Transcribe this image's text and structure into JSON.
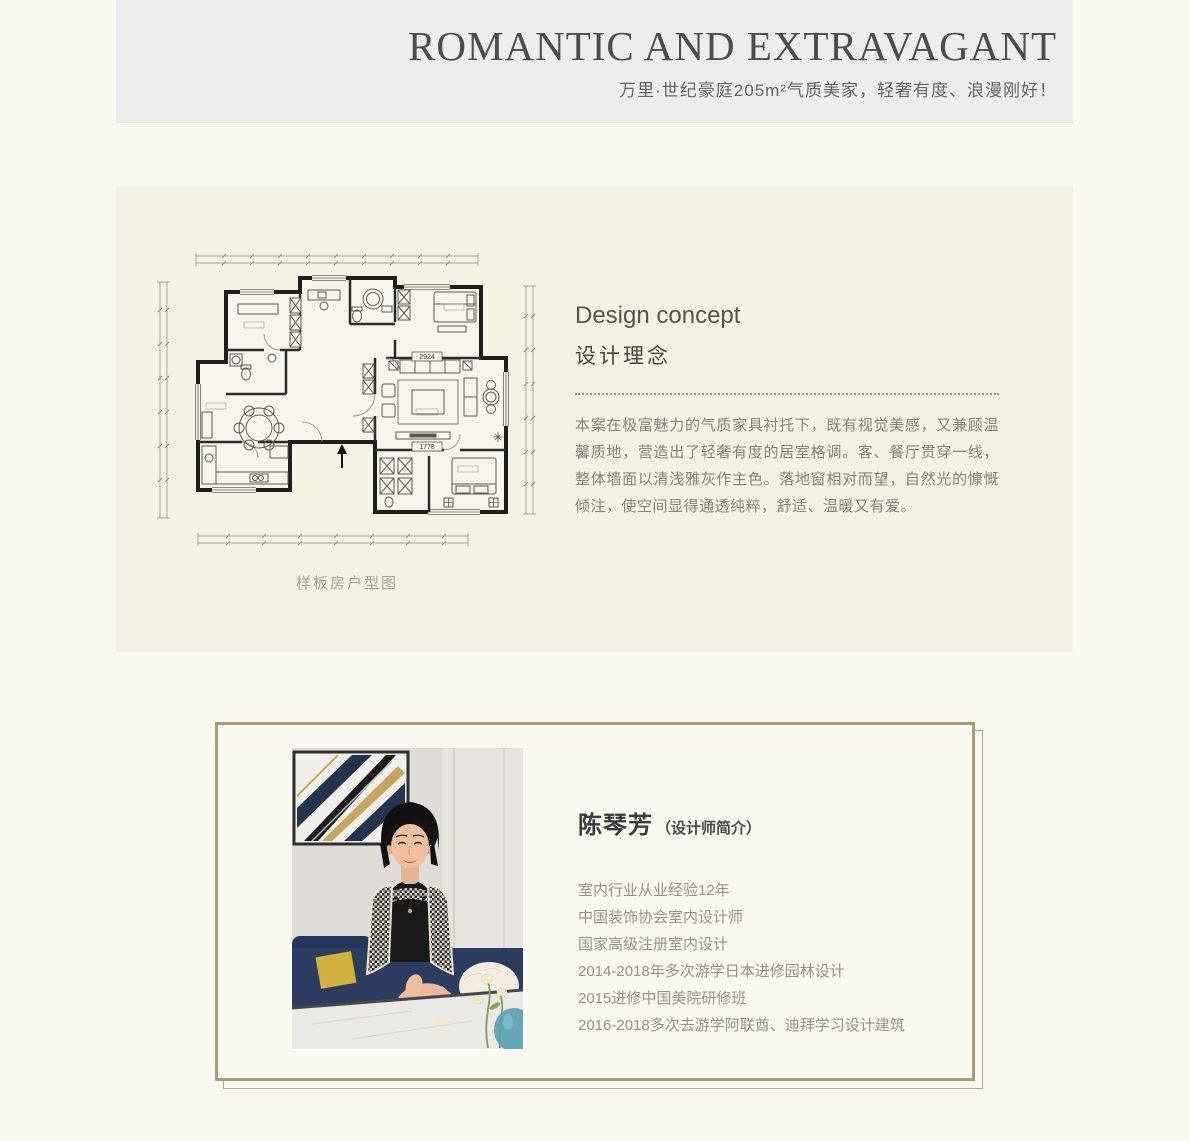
{
  "header": {
    "title": "ROMANTIC AND EXTRAVAGANT",
    "subtitle": "万里·世纪豪庭205m²气质美家，轻奢有度、浪漫刚好！"
  },
  "concept": {
    "heading_en": "Design concept",
    "heading_zh": "设计理念",
    "body": "本案在极富魅力的气质家具衬托下，既有视觉美感，又兼顾温馨质地，营造出了轻奢有度的居室格调。客、餐厅贯穿一线，整体墙面以清浅雅灰作主色。落地窗相对而望，自然光的慷慨倾注，使空间显得通透纯粹，舒适、温暖又有爱。",
    "floorplan": {
      "caption": "样板房户型图",
      "label_sofa": "2924",
      "label_floor": "1778"
    }
  },
  "designer": {
    "name": "陈琴芳",
    "name_suffix": "（设计师简介）",
    "credentials": [
      "室内行业从业经验12年",
      "中国装饰协会室内设计师",
      "国家高级注册室内设计",
      "2014-2018年多次游学日本进修园林设计",
      "2015进修中国美院研修班",
      "2016-2018多次去游学阿联酋、迪拜学习设计建筑"
    ]
  },
  "colors": {
    "page_bg": "#faf9f1",
    "header_bg": "#ededeb",
    "panel_bg": "#f5f1e3",
    "card_border_gold": "#ab9a76",
    "title_text": "#4c4c4c",
    "body_text": "#85837a"
  }
}
